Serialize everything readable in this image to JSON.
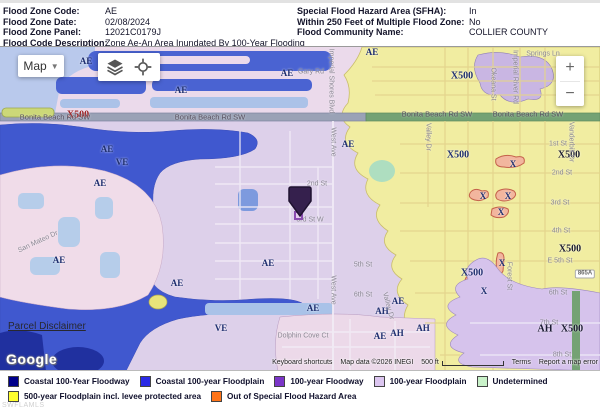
{
  "header": {
    "left": [
      {
        "label": "Flood Zone Code:",
        "value": "AE"
      },
      {
        "label": "Flood Zone Date:",
        "value": "02/08/2024"
      },
      {
        "label": "Flood Zone Panel:",
        "value": "12021C0179J"
      },
      {
        "label": "Flood Code Description:",
        "value": "Zone Ae-An Area Inundated By 100-Year Flooding"
      }
    ],
    "right": [
      {
        "label": "Special Flood Hazard Area (SFHA):",
        "value": "In"
      },
      {
        "label": "Within 250 Feet of Multiple Flood Zone:",
        "value": "No"
      },
      {
        "label": "Flood Community Name:",
        "value": "COLLIER COUNTY"
      }
    ]
  },
  "map": {
    "controls": {
      "map_button": "Map",
      "zoom_in": "+",
      "zoom_out": "−"
    },
    "links": {
      "parcel": "Parcel Disclaimer",
      "google": "Google"
    },
    "attribution": {
      "keyboard_shortcuts": "Keyboard shortcuts",
      "map_data": "Map data ©2026 INEGI",
      "scale": "500 ft",
      "terms": "Terms",
      "report": "Report a map error"
    },
    "marker_color": "#35204d",
    "labels": [
      {
        "text": "AE",
        "x": 86,
        "y": 14,
        "kind": "zone"
      },
      {
        "text": "AE",
        "x": 287,
        "y": 26,
        "kind": "zone"
      },
      {
        "text": "AE",
        "x": 181,
        "y": 43,
        "kind": "zone"
      },
      {
        "text": "AE",
        "x": 372,
        "y": 5,
        "kind": "zone"
      },
      {
        "text": "X500",
        "x": 462,
        "y": 29,
        "kind": "zone-big"
      },
      {
        "text": "X500",
        "x": 78,
        "y": 68,
        "kind": "zone-red"
      },
      {
        "text": "AE",
        "x": 107,
        "y": 102,
        "kind": "zone"
      },
      {
        "text": "VE",
        "x": 122,
        "y": 115,
        "kind": "zone"
      },
      {
        "text": "AE",
        "x": 100,
        "y": 136,
        "kind": "zone"
      },
      {
        "text": "AE",
        "x": 348,
        "y": 97,
        "kind": "zone"
      },
      {
        "text": "AE",
        "x": 59,
        "y": 213,
        "kind": "zone"
      },
      {
        "text": "AE",
        "x": 268,
        "y": 216,
        "kind": "zone"
      },
      {
        "text": "AE",
        "x": 177,
        "y": 236,
        "kind": "zone"
      },
      {
        "text": "VE",
        "x": 221,
        "y": 281,
        "kind": "zone"
      },
      {
        "text": "AE",
        "x": 313,
        "y": 261,
        "kind": "zone"
      },
      {
        "text": "X500",
        "x": 458,
        "y": 108,
        "kind": "zone-big"
      },
      {
        "text": "X500",
        "x": 569,
        "y": 108,
        "kind": "zone-dark"
      },
      {
        "text": "X",
        "x": 513,
        "y": 117,
        "kind": "zone"
      },
      {
        "text": "X",
        "x": 483,
        "y": 149,
        "kind": "zone"
      },
      {
        "text": "X",
        "x": 508,
        "y": 149,
        "kind": "zone"
      },
      {
        "text": "X",
        "x": 501,
        "y": 165,
        "kind": "zone"
      },
      {
        "text": "X500",
        "x": 570,
        "y": 202,
        "kind": "zone-dark"
      },
      {
        "text": "X",
        "x": 502,
        "y": 216,
        "kind": "zone"
      },
      {
        "text": "X500",
        "x": 472,
        "y": 226,
        "kind": "zone-big"
      },
      {
        "text": "X",
        "x": 484,
        "y": 244,
        "kind": "zone"
      },
      {
        "text": "AH",
        "x": 545,
        "y": 282,
        "kind": "zone-dark"
      },
      {
        "text": "X500",
        "x": 572,
        "y": 282,
        "kind": "zone-dark"
      },
      {
        "text": "AE",
        "x": 398,
        "y": 254,
        "kind": "zone"
      },
      {
        "text": "AH",
        "x": 382,
        "y": 264,
        "kind": "zone"
      },
      {
        "text": "AH",
        "x": 423,
        "y": 281,
        "kind": "zone"
      },
      {
        "text": "AH",
        "x": 397,
        "y": 286,
        "kind": "zone"
      },
      {
        "text": "AE",
        "x": 380,
        "y": 289,
        "kind": "zone"
      },
      {
        "text": "Gary Rd",
        "x": 311,
        "y": 25,
        "kind": "street"
      },
      {
        "text": "Springs Ln",
        "x": 543,
        "y": 7,
        "kind": "street"
      },
      {
        "text": "Imperial Shores Blvd",
        "x": 331,
        "y": 34,
        "kind": "street",
        "rot": 90
      },
      {
        "text": "Okeana St",
        "x": 493,
        "y": 37,
        "kind": "street",
        "rot": 90
      },
      {
        "text": "Imperial River Rd",
        "x": 515,
        "y": 30,
        "kind": "street",
        "rot": 90
      },
      {
        "text": "Bonita Beach Rd SW",
        "x": 55,
        "y": 70,
        "kind": "road"
      },
      {
        "text": "Bonita Beach Rd SW",
        "x": 210,
        "y": 70,
        "kind": "road"
      },
      {
        "text": "Bonita Beach Rd SW",
        "x": 437,
        "y": 67,
        "kind": "road"
      },
      {
        "text": "Bonita Beach Rd SW",
        "x": 528,
        "y": 67,
        "kind": "road"
      },
      {
        "text": "Valley Dr",
        "x": 428,
        "y": 90,
        "kind": "street",
        "rot": 90
      },
      {
        "text": "Vanderbilt Dr",
        "x": 571,
        "y": 95,
        "kind": "street",
        "rot": 90
      },
      {
        "text": "West Ave",
        "x": 333,
        "y": 95,
        "kind": "street",
        "rot": 90
      },
      {
        "text": "West Ave",
        "x": 333,
        "y": 243,
        "kind": "street",
        "rot": 90
      },
      {
        "text": "1st St",
        "x": 558,
        "y": 97,
        "kind": "street"
      },
      {
        "text": "2nd St",
        "x": 562,
        "y": 126,
        "kind": "street"
      },
      {
        "text": "3rd St",
        "x": 560,
        "y": 156,
        "kind": "street"
      },
      {
        "text": "4th St",
        "x": 561,
        "y": 184,
        "kind": "street"
      },
      {
        "text": "2nd St",
        "x": 317,
        "y": 137,
        "kind": "street"
      },
      {
        "text": "3rd St W",
        "x": 310,
        "y": 173,
        "kind": "street"
      },
      {
        "text": "San Mateo Dr",
        "x": 38,
        "y": 195,
        "kind": "street",
        "rot": -25
      },
      {
        "text": "5th St",
        "x": 363,
        "y": 218,
        "kind": "street"
      },
      {
        "text": "6th St",
        "x": 363,
        "y": 248,
        "kind": "street"
      },
      {
        "text": "Dolphin Cove Ct",
        "x": 303,
        "y": 289,
        "kind": "street"
      },
      {
        "text": "Valley Dr",
        "x": 388,
        "y": 259,
        "kind": "street",
        "rot": 75
      },
      {
        "text": "Forest St",
        "x": 509,
        "y": 229,
        "kind": "street",
        "rot": 90
      },
      {
        "text": "E 5th St",
        "x": 560,
        "y": 214,
        "kind": "street"
      },
      {
        "text": "6th St",
        "x": 558,
        "y": 246,
        "kind": "street"
      },
      {
        "text": "7th St",
        "x": 549,
        "y": 276,
        "kind": "street"
      },
      {
        "text": "8th St",
        "x": 562,
        "y": 308,
        "kind": "street"
      },
      {
        "text": "865A",
        "x": 585,
        "y": 227,
        "kind": "shield"
      }
    ]
  },
  "legend": {
    "rows": [
      [
        {
          "label": "Coastal 100-Year Floodway",
          "color": "#00008b"
        },
        {
          "label": "Coastal 100-year Floodplain",
          "color": "#2a2ae6"
        },
        {
          "label": "100-year Floodway",
          "color": "#7b35c8"
        },
        {
          "label": "100-year Floodplain",
          "color": "#dcc6f0"
        },
        {
          "label": "Undetermined",
          "color": "#c9f2c9"
        }
      ],
      [
        {
          "label": "500-year Floodplain incl. levee protected area",
          "color": "#ffff2e"
        },
        {
          "label": "Out of Special Flood Hazard Area",
          "color": "#ff7418"
        }
      ]
    ]
  },
  "watermark": "SWFLAMLS"
}
